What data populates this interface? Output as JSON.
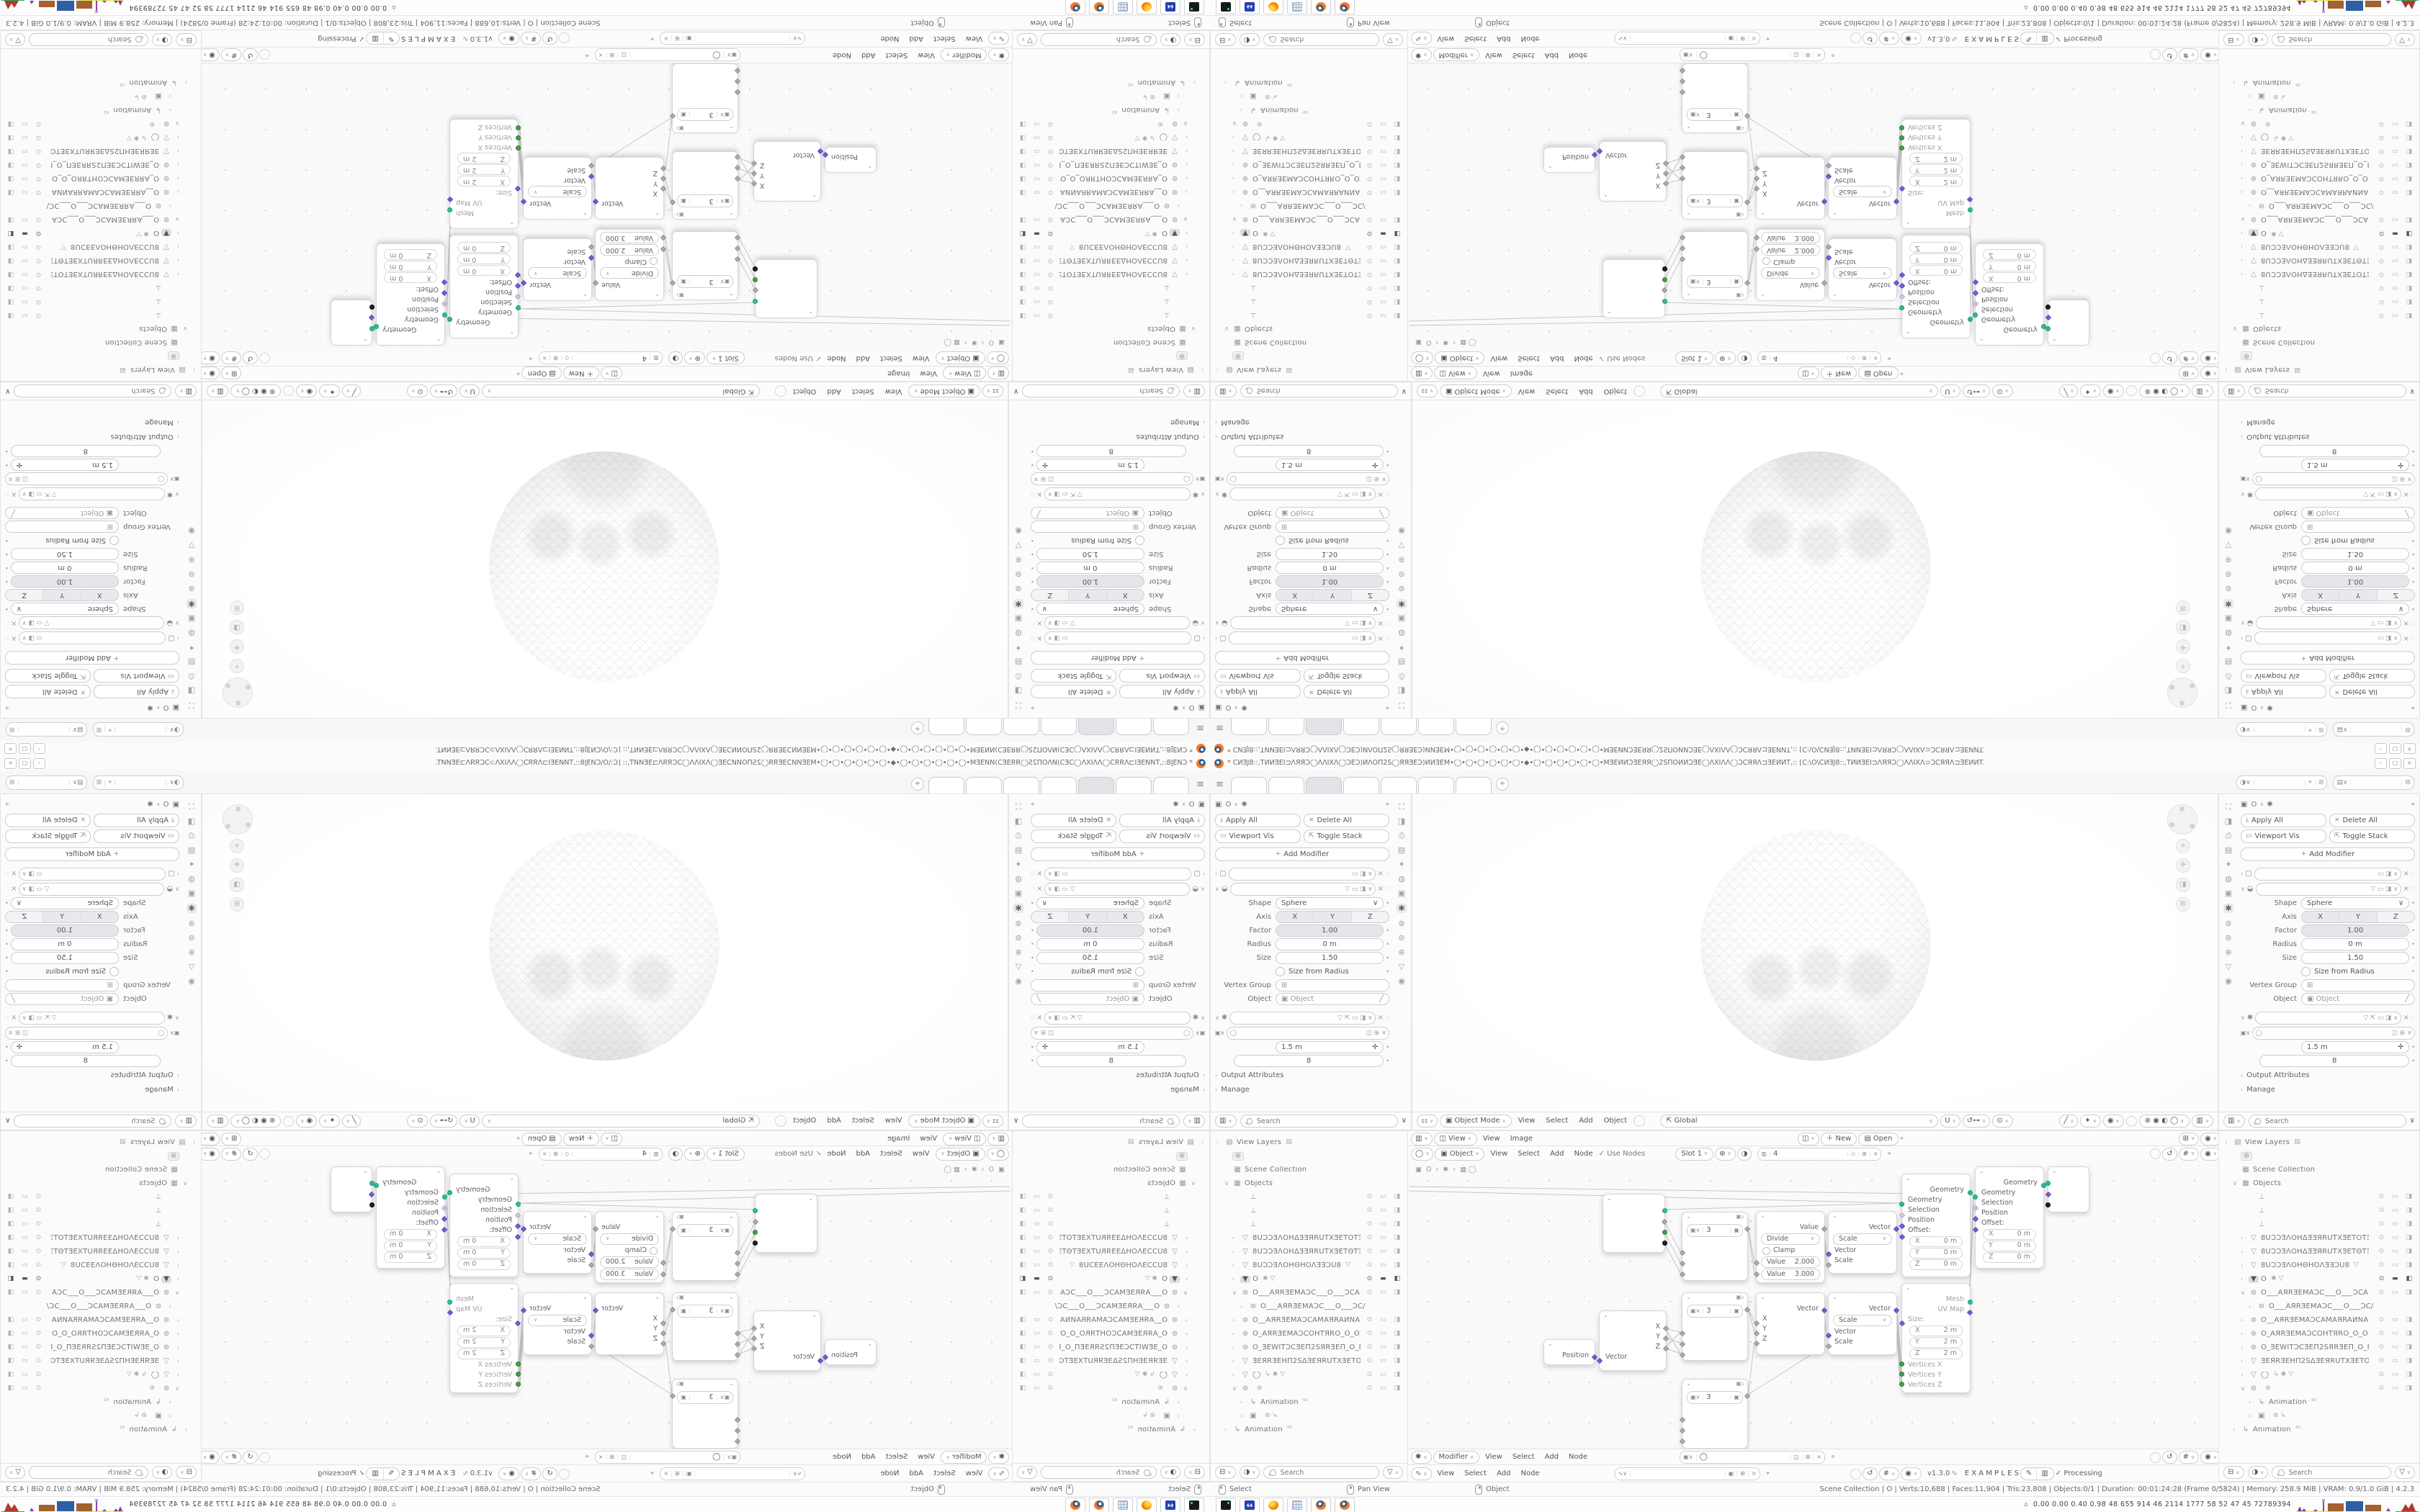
{
  "meta": {
    "app": "Blender 4.2.3 desktop screenshot, mirrored 2x2 kaleidoscope composite"
  },
  "tile": {
    "titlebar": {
      "title": "* CͶƎJ8::,TͶͶƎEI⊐ΛЯЯƆ◯ΛΛIXΛ◯ƆEƆ)ͶΛΟΠ2S◯ЯЯƎEƆ)ͶͶƎEM•◯•◯•◯•◯•◯•◯•◆•◯•◯•◯•◯•◯•◯•MƎEͶͶƆƎEЯЯ◯2SΠΟͶͶƆƎE◯ΛXIΛΛ◯ƆCЯЯΛ⊐ƎEͶͶT,:: [C:\\O\\CͶƎJ8::,TͶͶƎEI⊐ΛЯЯƆ◯ΛΛIXΛ⊃ƆCЯЯΛ⊐ƎEͶͶT.",
      "min": "–",
      "max": "▢",
      "close": "×"
    },
    "topbar": {
      "menu_icon": "≡",
      "new_tab": "+"
    },
    "props": {
      "breadcrumb_icon": "▣",
      "breadcrumb_obj": "O",
      "breadcrumb_sep": "›",
      "breadcrumb_mod": "✱",
      "pin": "⌖",
      "apply_all": "Apply All",
      "delete_all": "Delete All",
      "viewport_vis": "Viewport Vis",
      "toggle_stack": "Toggle Stack",
      "add_modifier": "Add Modifier",
      "shape_label": "Shape",
      "shape_value": "Sphere",
      "axis_label": "Axis",
      "axis_x": "X",
      "axis_y": "Y",
      "axis_z": "Z",
      "factor_label": "Factor",
      "factor_value": "1.00",
      "radius_label": "Radius",
      "radius_value": "0 m",
      "size_label": "Size",
      "size_value": "1.50",
      "size_from_radius": "Size from Radius",
      "vertex_group_label": "Vertex Group",
      "object_label": "Object",
      "object_placeholder": "Object",
      "gn_value_m": "1.5 m",
      "gn_value_n": "8",
      "output_attributes": "Output Attributes",
      "manage": "Manage",
      "search_placeholder": "Search"
    },
    "viewport": {
      "mode": "Object Mode",
      "menu_view": "View",
      "menu_select": "Select",
      "menu_add": "Add",
      "menu_object": "Object",
      "orientation": "Global"
    },
    "image_header": {
      "view_btn": "View",
      "menu_view": "View",
      "menu_image": "Image",
      "new_btn": "New",
      "open_btn": "Open"
    },
    "shader_header": {
      "object_btn": "Object",
      "menu_view": "View",
      "menu_select": "Select",
      "menu_add": "Add",
      "menu_node": "Node",
      "use_nodes": "Use Nodes",
      "slot": "Slot 1",
      "image_name": "4"
    },
    "gn_header": {
      "mode_btn": "Modifier",
      "menu_view": "View",
      "menu_select": "Select",
      "menu_add": "Add",
      "menu_node": "Node"
    },
    "dna_header": {
      "menu_view": "View",
      "menu_select": "Select",
      "menu_add": "Add",
      "menu_node": "Node",
      "version": "v1.3.0",
      "examples": "E X A M P L E S",
      "processing": "Processing",
      "check": "✓"
    },
    "graph": {
      "bc_icon": "▣",
      "bc_obj": "O",
      "bc_sep": "›",
      "bc_mod": "✱",
      "bc_grp": "▦ ◯",
      "n3_value": "3",
      "divide": {
        "out": "Value",
        "op": "Divide",
        "clamp": "Clamp",
        "v1_label": "Value",
        "v1": "2.000",
        "v2_label": "Value",
        "v2": "3.000"
      },
      "combine": {
        "out": "Vector",
        "x": "X",
        "y": "Y",
        "z": "Z"
      },
      "position": {
        "out": "Position"
      },
      "separate": {
        "x": "X",
        "y": "Y",
        "z": "Z",
        "invec": "Vector"
      },
      "scale": {
        "out": "Vector",
        "op": "Scale",
        "in_vector": "Vector",
        "in_scale": "Scale"
      },
      "setpos": {
        "out": "Geometry",
        "in_geo": "Geometry",
        "sel": "Selection",
        "pos": "Position",
        "off": "Offset:",
        "x": "X",
        "y": "Y",
        "z": "Z",
        "zero": "0 m"
      },
      "cube": {
        "mesh": "Mesh",
        "uv": "UV Map",
        "size": "Size:",
        "x": "X",
        "y": "Y",
        "z": "Z",
        "two": "2 m",
        "vx": "Vertices X",
        "vy": "Vertices Y",
        "vz": "Vertices Z"
      }
    },
    "outliner": {
      "search_placeholder": "Search",
      "items": [
        {
          "caret": "›",
          "icon": "▤",
          "label": "View Layers",
          "extra": "▤",
          "pad": 0,
          "vis": ""
        },
        {
          "icon": "⊕",
          "label": "",
          "pad": 1,
          "cls": "boxed",
          "vis": ""
        },
        {
          "icon": "▦",
          "label": "Scene Collection",
          "pad": 1,
          "vis": ""
        },
        {
          "caret": "∨",
          "icon": "▦",
          "label": "Objects",
          "pad": 1,
          "vis": ""
        },
        {
          "icon": "⊥",
          "label": "",
          "pad": 3,
          "vis": "⊙ ▭ ◨"
        },
        {
          "icon": "⊥",
          "label": "",
          "pad": 3,
          "vis": "⊙ ▭ ◨"
        },
        {
          "icon": "⊥",
          "label": "",
          "pad": 3,
          "vis": "⊙ ▭ ◨"
        },
        {
          "caret": "›",
          "icon": "▽",
          "label": "8UƆƆƎΛΟΗΔƎƎЯRUTXƎETOTƎEXT",
          "pad": 2,
          "vis": "⊙ ▭ ◨"
        },
        {
          "caret": "›",
          "icon": "▽",
          "label": "8UƆƆƎΛΟΗΔƎƎЯRUTXƎETΘTƎEXT",
          "pad": 2,
          "vis": "⊙ ▭ ◨"
        },
        {
          "caret": "›",
          "icon": "▽",
          "label": "8UƆƆƎΛΟΗΘΗΟΛƎƎƆU8",
          "extra": "▽",
          "pad": 2,
          "vis": "⊙ ▭ ◨"
        },
        {
          "caret": "›",
          "icon": "▼",
          "label": "O",
          "extra": "✱ ▽",
          "pad": 2,
          "cls": "sel",
          "vis": "⊙ ▬ ◧"
        },
        {
          "caret": "∨",
          "icon": "⊚",
          "label": "O___AЯRƎEMAƆC___O___ƆCAMƎ",
          "pad": 2,
          "vis": "⊙ ▭ ◨"
        },
        {
          "caret": "›",
          "icon": "⊚",
          "label": "O___AЯRƎEMAƆC___O___ƆC/",
          "pad": 3,
          "vis": ""
        },
        {
          "caret": "›",
          "icon": "⊚",
          "label": "O__AЯRƎEMAƆCAMAЯRAͶNAΠ_C",
          "pad": 2,
          "vis": "⊙ ▭ ◨"
        },
        {
          "caret": "›",
          "icon": "⊚",
          "label": "O_AЯRƎEMAƆCOHTЯRO_O_OЯRTH",
          "pad": 2,
          "vis": "⊙ ▭ ◨"
        },
        {
          "caret": "›",
          "icon": "⊚",
          "label": "O_ƎEWITƆCƎEΠ2SЯRƎEΠ_O_ΠƎEЯR",
          "pad": 2,
          "vis": "⊙ ▭ ◨"
        },
        {
          "caret": "›",
          "icon": "▽",
          "label": "ƎEЯRƎEHΠ2SΔƎEЯRUTXƎETOTƎEXT",
          "pad": 2,
          "vis": "⊙ ▭ ◨"
        },
        {
          "caret": "›",
          "icon": "▽",
          "label": "◯",
          "extra": "↳ ✱ ▽",
          "pad": 2,
          "vis": "⊙ ▭ ◨"
        },
        {
          "caret": "∨",
          "icon": "⊚",
          "label": "",
          "extra": "⊛",
          "pad": 2,
          "vis": "⊙ ▭ ◨"
        },
        {
          "caret": "›",
          "icon": "↳",
          "label": "Animation",
          "extra": "⁴²",
          "pad": 3,
          "vis": ""
        },
        {
          "caret": "›",
          "icon": "▣",
          "label": "",
          "extra": "⊛  ↳",
          "pad": 3,
          "vis": ""
        },
        {
          "caret": "›",
          "icon": "↳",
          "label": "Animation",
          "extra": "⁴²",
          "pad": 1,
          "vis": ""
        }
      ]
    },
    "status": {
      "hint_select": "Select",
      "hint_pan": "Pan View",
      "hint_object": "Object",
      "stats": "Scene Collection  |  O  |  Verts:10,688  |  Faces:11,904  |  Tris:23,808  |  Objects:0/1  |  Duration: 00:01:24:28 (Frame 0/5824)  |  Memory: 258.9 MiB  |  VRAM: 0.9/1.0 GiB  |  4.2.3"
    },
    "taskbar": {
      "caret": "⌂",
      "numbers": "0.00 0.00 0.40 0.98   48   655  914   46   2114 1777   58    52    47    45  72789394",
      "c64_label": "64"
    }
  }
}
